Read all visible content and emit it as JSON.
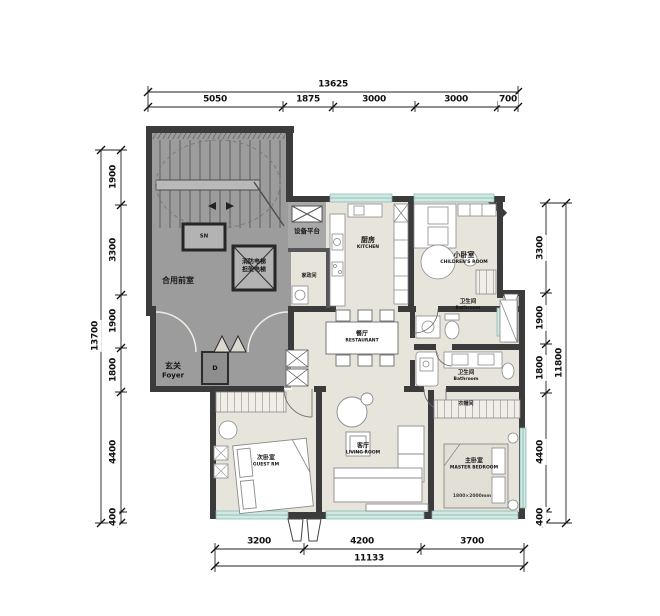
{
  "dimensions": {
    "top": {
      "overall": "13625",
      "segments": [
        "5050",
        "1875",
        "3000",
        "3000",
        "700"
      ]
    },
    "left": {
      "overall": "13700",
      "segments": [
        "1900",
        "3300",
        "1900",
        "1800",
        "4400",
        "400"
      ]
    },
    "right": {
      "overall": "11800",
      "segments": [
        "3300",
        "1900",
        "1800",
        "4400",
        "400"
      ]
    },
    "bottom": {
      "overall": "11133",
      "segments": [
        "3200",
        "4200",
        "3700"
      ]
    }
  },
  "rooms": {
    "shared_vestibule": {
      "cn": "合用前室"
    },
    "elevator": {
      "code": "SN"
    },
    "fire_elevator": {
      "line1": "消防电梯",
      "line2": "担架电梯"
    },
    "equipment_platform": {
      "cn": "设备平台"
    },
    "foyer": {
      "cn": "玄关",
      "en": "Foyer"
    },
    "entry_door": {
      "code": "D"
    },
    "housekeeping": {
      "cn": "家政间"
    },
    "kitchen": {
      "cn": "厨房",
      "en": "KITCHEN"
    },
    "small_bedroom": {
      "cn": "小卧室",
      "en": "CHILDREN'S ROOM"
    },
    "bathroom_top": {
      "cn": "卫生间",
      "en": "Bathroom"
    },
    "bathroom_mid": {
      "cn": "卫生间",
      "en": "Bathroom"
    },
    "dining": {
      "cn": "餐厅",
      "en": "RESTAURANT"
    },
    "cloakroom": {
      "cn": "衣帽间"
    },
    "guest_bedroom": {
      "cn": "次卧室",
      "en": "GUEST RM"
    },
    "living_room": {
      "cn": "客厅",
      "en": "LIVING ROOM"
    },
    "master_bedroom": {
      "cn": "主卧室",
      "en": "MASTER BEDROOM",
      "bed": "1800×2000mm"
    }
  },
  "colors": {
    "wall": "#3b3b3b",
    "core_fill": "#9c9c9c",
    "floor_fill": "#e7e4db",
    "window": "#cfe9e4"
  }
}
